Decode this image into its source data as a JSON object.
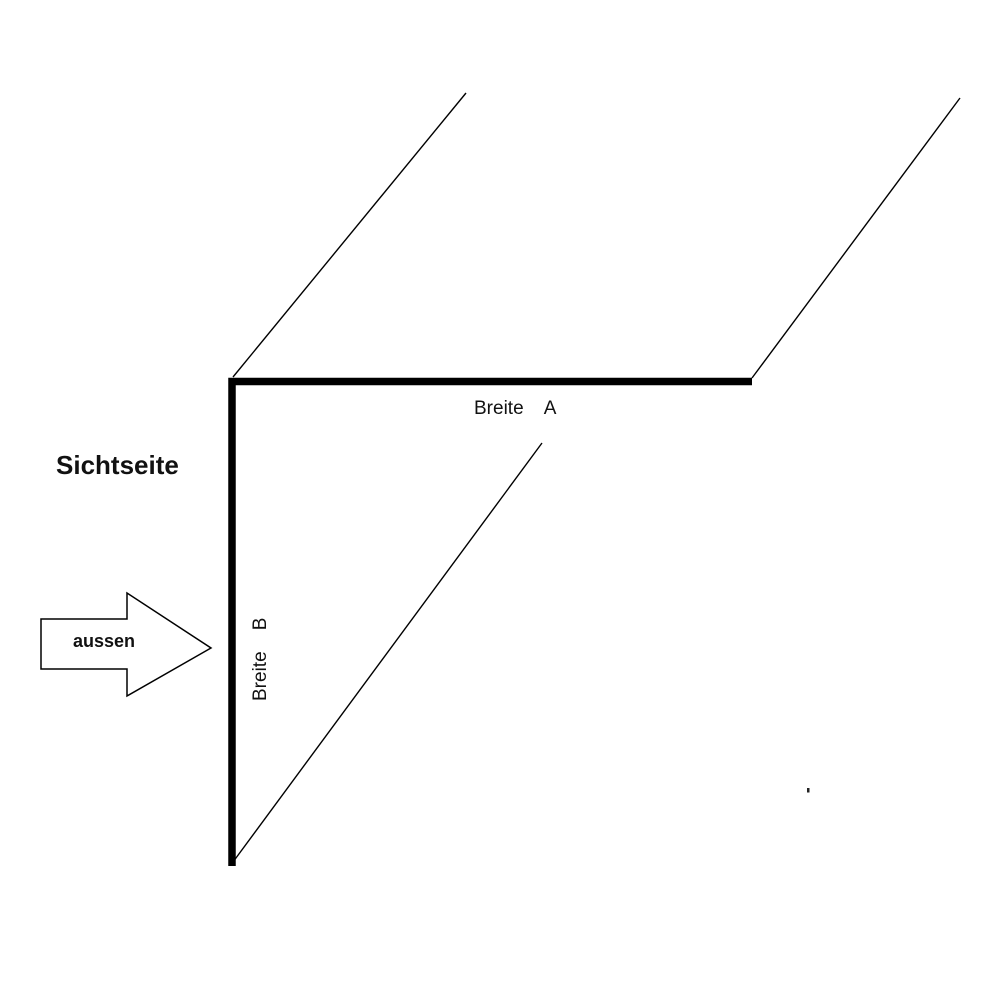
{
  "diagram": {
    "description": "Technical drawing of an L-shaped angle profile (corner flashing) in perspective",
    "labels": {
      "sichtseite": "Sichtseite",
      "aussen": "aussen",
      "breite_a": "Breite    A",
      "breite_b": "Breite    B"
    },
    "colors": {
      "background": "#ffffff",
      "line": "#000000",
      "arrow_fill": "#ffffff",
      "text": "#111111"
    }
  }
}
